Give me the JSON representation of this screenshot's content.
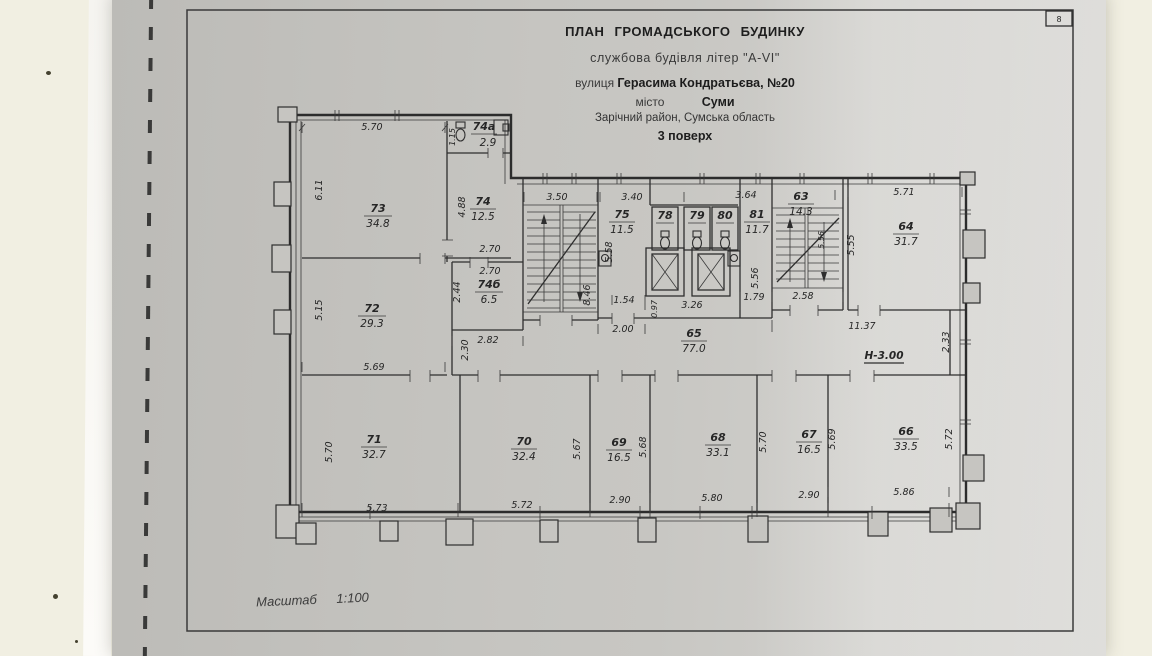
{
  "title_block": {
    "line1": "ПЛАН  ГРОМАДСЬКОГО  БУДИНКУ",
    "line2": "службова будівля літер \"А-VI\"",
    "line3_label": "вулиця",
    "line3_value": "Герасима Кондратьєва, №20",
    "line4_label": "місто",
    "line4_value": "Суми",
    "line5": "Зарічний район, Сумська область",
    "line6": "3 поверх"
  },
  "scale_note": {
    "label": "Масштаб",
    "value": "1:100"
  },
  "sheet_mark": "8",
  "height_note": "Н-3.00",
  "symbols": [
    "staircase",
    "elevator-shaft",
    "toilet",
    "sink"
  ],
  "rooms": [
    {
      "number": "73",
      "area": "34.8"
    },
    {
      "number": "74а",
      "area": "2.9"
    },
    {
      "number": "74",
      "area": "12.5"
    },
    {
      "number": "74б",
      "area": "6.5"
    },
    {
      "number": "72",
      "area": "29.3"
    },
    {
      "number": "75",
      "area": "11.5"
    },
    {
      "number": "78",
      "area": ""
    },
    {
      "number": "79",
      "area": ""
    },
    {
      "number": "80",
      "area": ""
    },
    {
      "number": "81",
      "area": "11.7"
    },
    {
      "number": "63",
      "area": "14.3"
    },
    {
      "number": "64",
      "area": "31.7"
    },
    {
      "number": "65",
      "area": "77.0"
    },
    {
      "number": "71",
      "area": "32.7"
    },
    {
      "number": "70",
      "area": "32.4"
    },
    {
      "number": "69",
      "area": "16.5"
    },
    {
      "number": "68",
      "area": "33.1"
    },
    {
      "number": "67",
      "area": "16.5"
    },
    {
      "number": "66",
      "area": "33.5"
    }
  ],
  "dims": {
    "d73_w": "5.70",
    "d73_h": "6.11",
    "d72_h": "5.15",
    "d74a_h": "1.15",
    "d74_h": "4.88",
    "d74b_w1": "2.70",
    "d74b_w2": "2.70",
    "d74b_h": "2.44",
    "d74b_wb": "2.82",
    "dcorrw_h": "2.30",
    "dst1_w": "3.50",
    "dst1_h": "8.46",
    "d75_w": "3.40",
    "d75_h": "5.58",
    "dlob1": "1.54",
    "dlob2": "2.00",
    "dshaft_h": "0.97",
    "dshaft_w": "3.26",
    "d81_w": "3.64",
    "d81_wb": "1.79",
    "d81_h": "5.56",
    "dst2_h": "5.56",
    "dst2_wb": "2.58",
    "d64_w": "5.71",
    "d64_h": "5.55",
    "dcorr_w": "11.37",
    "dcorr_h": "2.33",
    "d71_w": "5.69",
    "d71_h": "5.70",
    "d71_wb": "5.73",
    "d70_wb": "5.72",
    "d70_h": "5.67",
    "d69_wb": "2.90",
    "d69_h": "5.68",
    "d68_wb": "5.80",
    "d68_h": "5.70",
    "d67_wb": "2.90",
    "d67_h": "5.69",
    "d66_wb": "5.86",
    "d66_h": "5.72"
  }
}
